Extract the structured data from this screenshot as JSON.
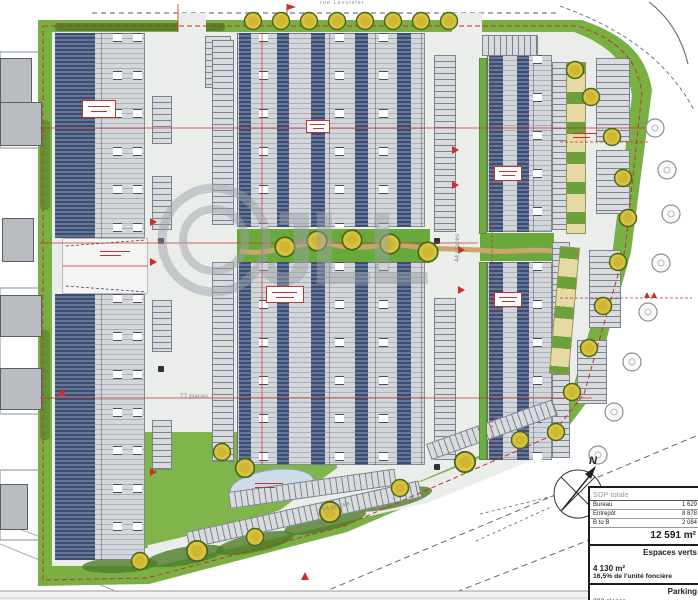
{
  "plan": {
    "watermark": "JLL",
    "north_label": "N",
    "street_label": "rue Lavoisier",
    "road_labels": {
      "mid_road": "44 places",
      "bottom_road": "54 places",
      "left_road": "77 places"
    }
  },
  "legend": {
    "header": "SDP totale",
    "rows": [
      {
        "label": "Bureau",
        "value": "1 629"
      },
      {
        "label": "Entrepôt",
        "value": "8 878"
      },
      {
        "label": "B to B",
        "value": "2 084"
      }
    ],
    "total": "12 591 m²",
    "espaces_verts": {
      "title": "Espaces verts",
      "area": "4 130 m²",
      "pct": "16,5% de l'unité foncière"
    },
    "parking": {
      "title": "Parking",
      "value": "232 places"
    }
  },
  "colors": {
    "grass": "#79b043",
    "hedge": "#4e7c28",
    "road": "#ebedeb",
    "solar_panel": "#3c4d6d",
    "building_roof": "#d3d6da",
    "annotation_red": "#c9302c",
    "tree": "#d9c33c",
    "pond": "#ccdce8",
    "watermark_gray": "#9da2a8"
  }
}
